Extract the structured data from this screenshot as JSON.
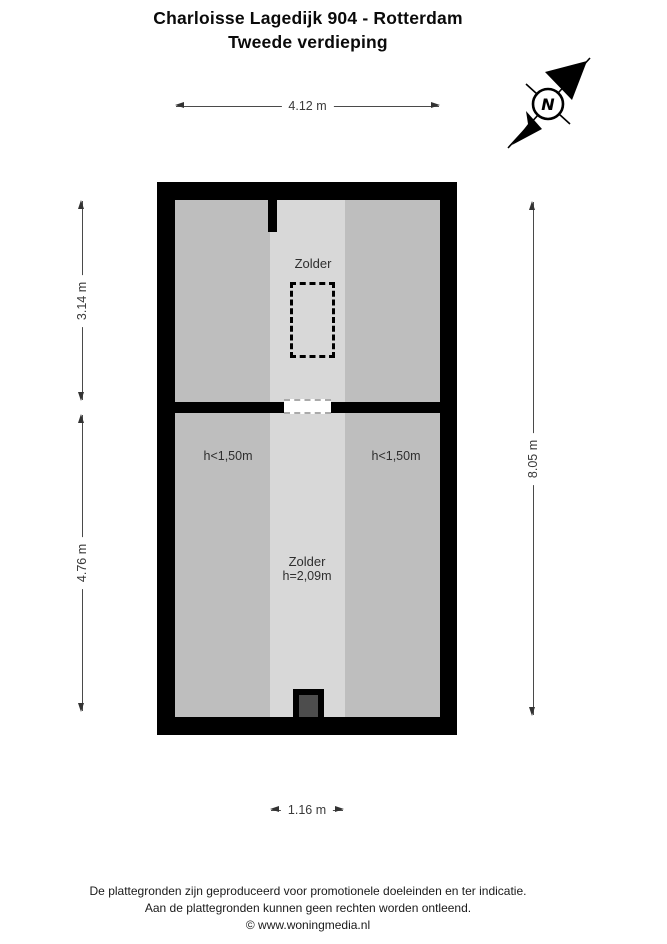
{
  "title": {
    "line1": "Charloisse Lagedijk 904 - Rotterdam",
    "line2": "Tweede verdieping"
  },
  "compass": {
    "north_label": "N"
  },
  "dimensions": {
    "top_width": "4.12 m",
    "upper_room_depth": "3.14 m",
    "lower_room_depth": "4.76 m",
    "total_depth": "8.05 m",
    "strip_width": "1.16 m"
  },
  "floorplan": {
    "upper_room": {
      "label": "Zolder"
    },
    "lower_room": {
      "label": "Zolder",
      "ceiling_height": "h=2,09m",
      "low_height_left": "h<1,50m",
      "low_height_right": "h<1,50m"
    }
  },
  "footer": {
    "line1": "De plattegronden zijn geproduceerd voor promotionele doeleinden en ter indicatie.",
    "line2": "Aan de plattegronden kunnen geen rechten worden ontleend.",
    "line3": "© www.woningmedia.nl"
  },
  "colors": {
    "wall": "#000000",
    "room_fill": "#bebebe",
    "center_strip_fill": "#d8d8d8",
    "chimney_fill": "#4d4d4d",
    "dimension_text": "#3a3a3a"
  }
}
